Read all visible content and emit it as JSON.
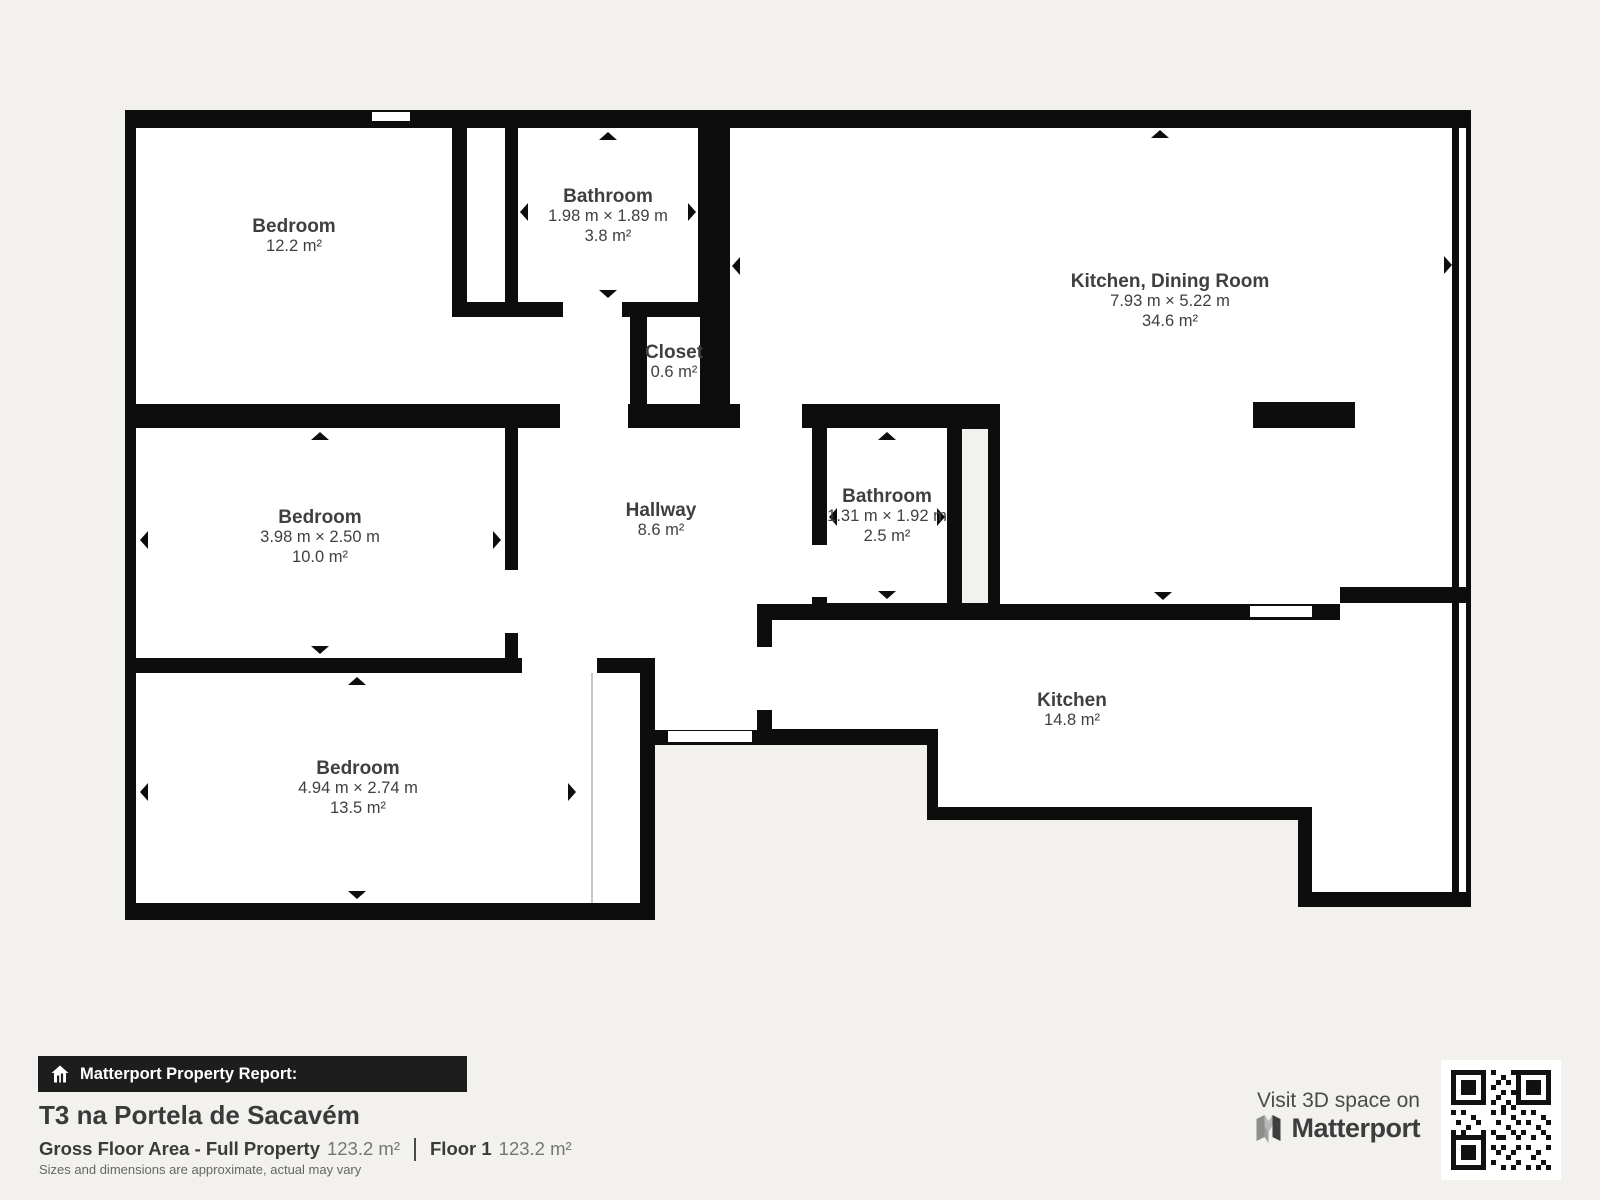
{
  "plan": {
    "wall_color": "#0d0d0d",
    "background": "#f2f1ee",
    "room_fill": "#ffffff",
    "label_color": "#3f3f3f",
    "rooms": [
      {
        "name": "Bedroom",
        "area": "12.2 m²"
      },
      {
        "name": "Bathroom",
        "dims": "1.98 m × 1.89 m",
        "area": "3.8 m²"
      },
      {
        "name": "Kitchen, Dining Room",
        "dims": "7.93 m × 5.22 m",
        "area": "34.6 m²"
      },
      {
        "name": "Closet",
        "area": "0.6 m²"
      },
      {
        "name": "Bedroom",
        "dims": "3.98 m × 2.50 m",
        "area": "10.0 m²"
      },
      {
        "name": "Hallway",
        "area": "8.6 m²"
      },
      {
        "name": "Bathroom",
        "dims": "1.31 m × 1.92 m",
        "area": "2.5 m²"
      },
      {
        "name": "Bedroom",
        "dims": "4.94 m × 2.74 m",
        "area": "13.5 m²"
      },
      {
        "name": "Kitchen",
        "area": "14.8 m²"
      }
    ]
  },
  "footer": {
    "report_label": "Matterport Property Report:",
    "property_title": "T3 na Portela de Sacavém",
    "gfa_label": "Gross Floor Area - Full Property",
    "gfa_value": "123.2 m²",
    "floor_label": "Floor 1",
    "floor_value": "123.2 m²",
    "disclaimer": "Sizes and dimensions are approximate, actual may vary"
  },
  "branding": {
    "visit_text": "Visit 3D space on",
    "brand_name": "Matterport"
  }
}
